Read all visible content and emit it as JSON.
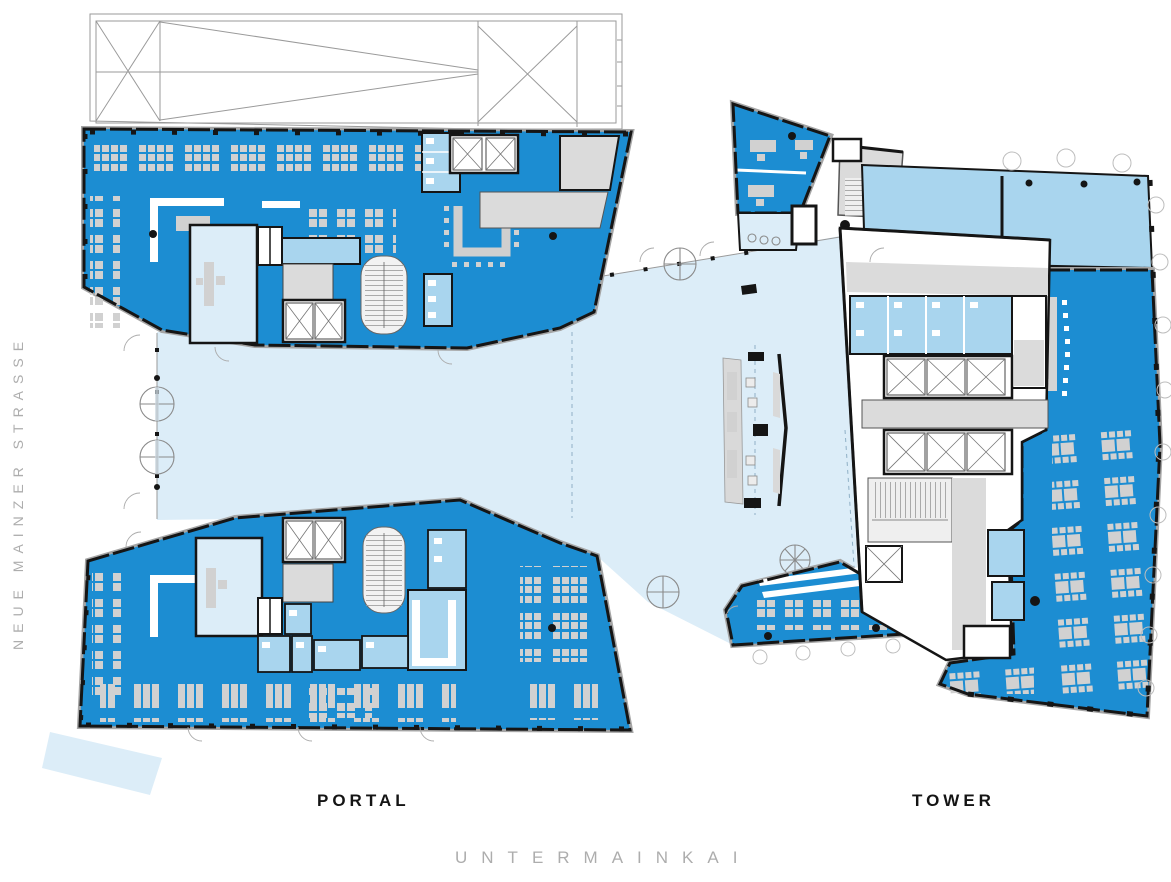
{
  "labels": {
    "street_left": "NEUE MAINZER STRASSE",
    "street_bottom": "UNTERMAINKAI",
    "building_left": "PORTAL",
    "building_right": "TOWER"
  },
  "colors": {
    "office_blue": "#1C8DD2",
    "room_blue": "#A9D5EE",
    "atrium_blue": "#DCEDF8",
    "furniture_gray": "#D1D1D1",
    "core_gray": "#DBDBDB",
    "wall_black": "#151515",
    "outline_gray": "#A5A5A5",
    "street_text_gray": "#ADADAD",
    "label_text_black": "#141414"
  }
}
